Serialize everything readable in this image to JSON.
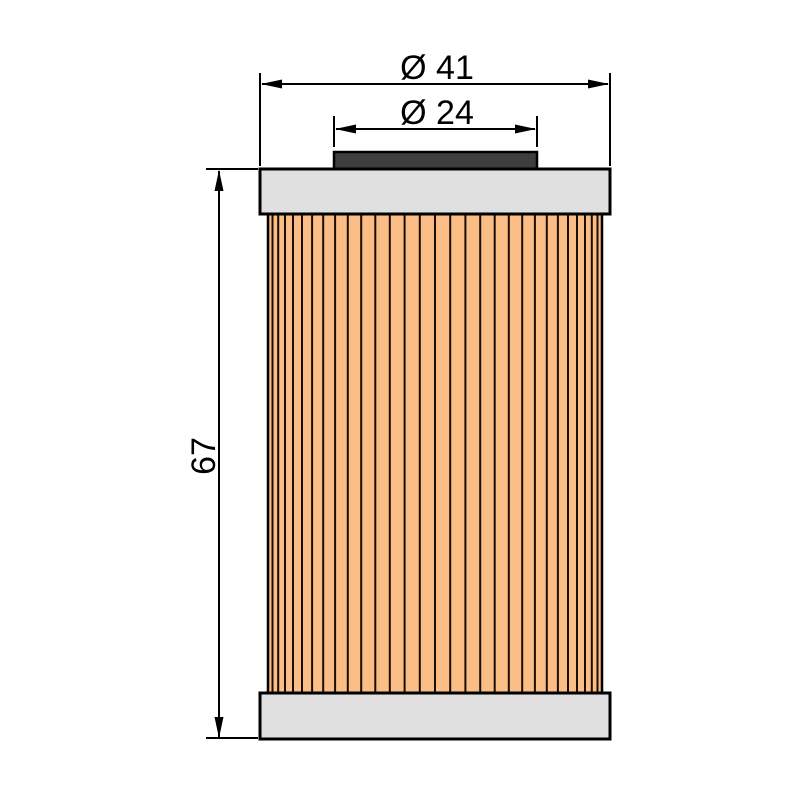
{
  "diagram": {
    "type": "technical-dimension-drawing",
    "subject": "oil filter cartridge, side elevation view",
    "dimensions": [
      {
        "id": "outer_diameter",
        "label": "Ø 41",
        "orientation": "horizontal",
        "refers_to": "outer diameter of end caps"
      },
      {
        "id": "gasket_diameter",
        "label": "Ø 24",
        "orientation": "horizontal",
        "refers_to": "diameter of top gasket"
      },
      {
        "id": "overall_height",
        "label": "67",
        "orientation": "vertical",
        "refers_to": "overall height of filter"
      }
    ],
    "parts": [
      "top gasket",
      "top end cap",
      "pleated filter media",
      "bottom end cap"
    ],
    "pleat_line_count": 29,
    "colors": {
      "background": "#FFFFFF",
      "filter_media": "#F9BD85",
      "pleat_line": "#1A0E02",
      "end_cap": "#E0E0E0",
      "gasket": "#3E3E3E",
      "outline": "#000000",
      "dimension_line": "#000000",
      "text": "#000000"
    }
  }
}
